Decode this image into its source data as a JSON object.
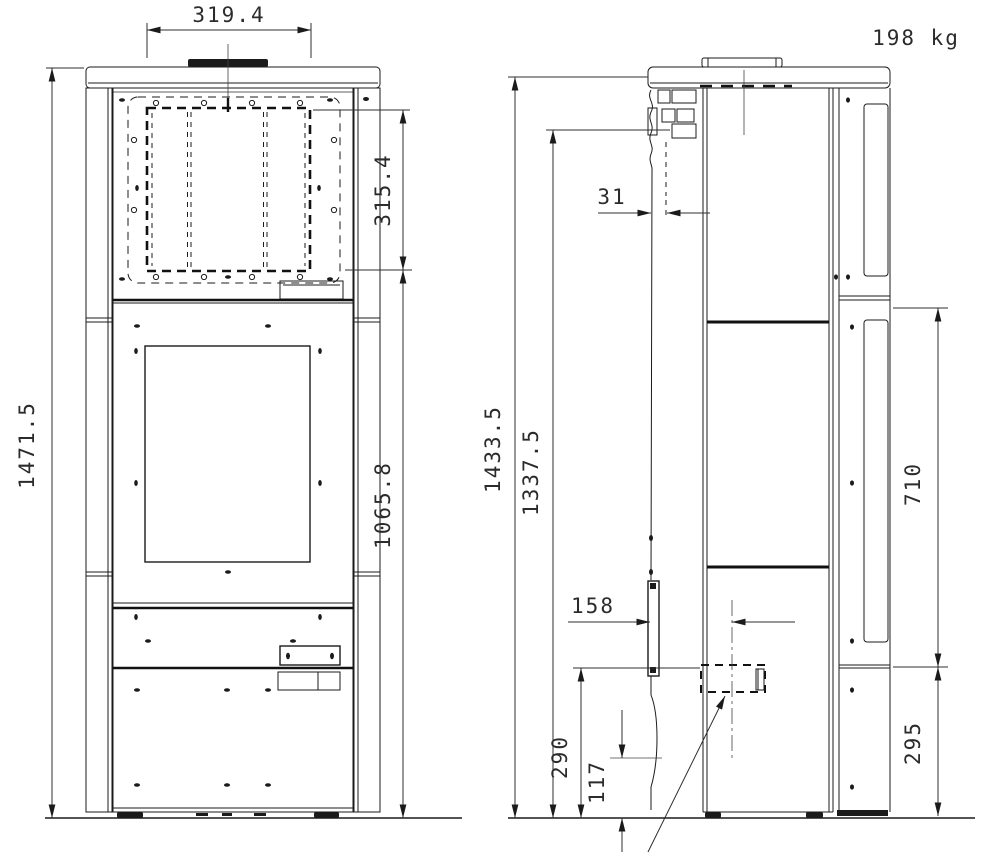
{
  "labels": {
    "weight": "198 kg"
  },
  "dimensions": {
    "front_opening_width": "319.4",
    "front_opening_height": "315.4",
    "front_total_height": "1471.5",
    "front_upper_height": "1065.8",
    "side_flue_offset": "31",
    "side_height_top": "1433.5",
    "side_height_connection": "1337.5",
    "side_window_height": "710",
    "side_handle_distance": "158",
    "side_outlet_height": "290",
    "side_intake_height": "117",
    "side_base_height": "295"
  }
}
